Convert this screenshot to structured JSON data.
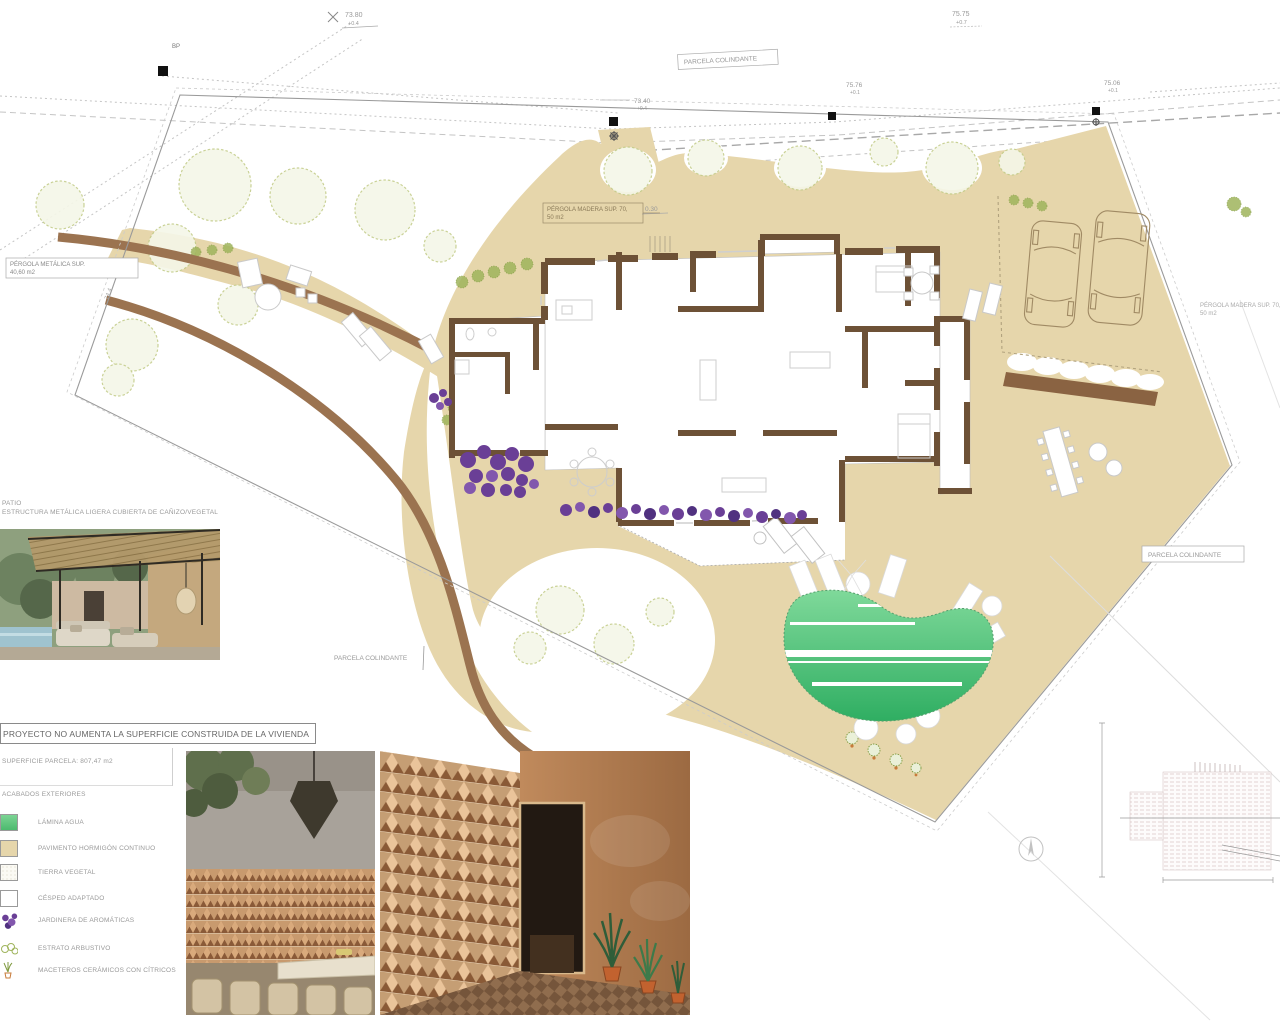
{
  "note": {
    "text": "PROYECTO NO AUMENTA LA SUPERFICIE CONSTRUIDA DE LA VIVIENDA"
  },
  "legend": {
    "superficie": "SUPERFICIE PARCELA: 807,47 m2",
    "section_title": "ACABADOS EXTERIORES",
    "items": [
      {
        "label": "LÁMINA AGUA",
        "swatch": "water",
        "color": "#4cba6e"
      },
      {
        "label": "PAVIMENTO HORMIGÓN CONTINUO",
        "swatch": "paving",
        "color": "#e6d6ab"
      },
      {
        "label": "TIERRA VEGETAL",
        "swatch": "soil",
        "color": "#f6f5ec"
      },
      {
        "label": "CÉSPED ADAPTADO",
        "swatch": "grass",
        "color": "#ffffff"
      },
      {
        "label": "JARDINERA DE AROMÁTICAS",
        "swatch": "planter",
        "color": "#6a3f96"
      },
      {
        "label": "ESTRATO ARBUSTIVO",
        "swatch": "shrub",
        "color": "#9fb45c"
      },
      {
        "label": "MACETEROS CERÁMICOS CON CÍTRICOS",
        "swatch": "pots",
        "color": "#7f9a3f"
      }
    ]
  },
  "photos": {
    "pergola_caption_1": "PATIO",
    "pergola_caption_2": "ESTRUCTURA METÁLICA LIGERA CUBIERTA DE CAÑIZO/VEGETAL"
  },
  "plan": {
    "labels": {
      "parcela_colindante_top": "PARCELA COLINDANTE",
      "parcela_colindante_left": "PARCELA COLINDANTE",
      "parcela_colindante_right": "PARCELA COLINDANTE",
      "pergola_metalica_1": "PÉRGOLA METÁLICA SUP.",
      "pergola_metalica_2": "40,60 m2",
      "pergola_madera_1": "PÉRGOLA MADERA SUP. 70,",
      "pergola_madera_2": "50 m2",
      "pergola_madera_right_1": "PÉRGOLA MADERA SUP. 70,",
      "pergola_madera_right_2": "50 m2",
      "bp_marker": "BP",
      "boundary_length": "74.4"
    },
    "measurements": [
      {
        "value": "73.80",
        "delta": "+0.4"
      },
      {
        "value": "75.75",
        "delta": "+0.7"
      },
      {
        "value": "73.40",
        "delta": "+0.4"
      },
      {
        "value": "75.76",
        "delta": "+0.1"
      },
      {
        "value": "75.06",
        "delta": "+0.1"
      },
      {
        "value": "0.30",
        "delta": ""
      }
    ],
    "colors": {
      "paving_tan": "#e6d6ab",
      "curb_brown": "#9b7350",
      "wall_brown": "#6d5136",
      "pool_green_light": "#7fd99a",
      "pool_green_dark": "#2fae62",
      "planter_purple": "#6a3f96",
      "vegetation_green": "#c4cd8b"
    }
  }
}
